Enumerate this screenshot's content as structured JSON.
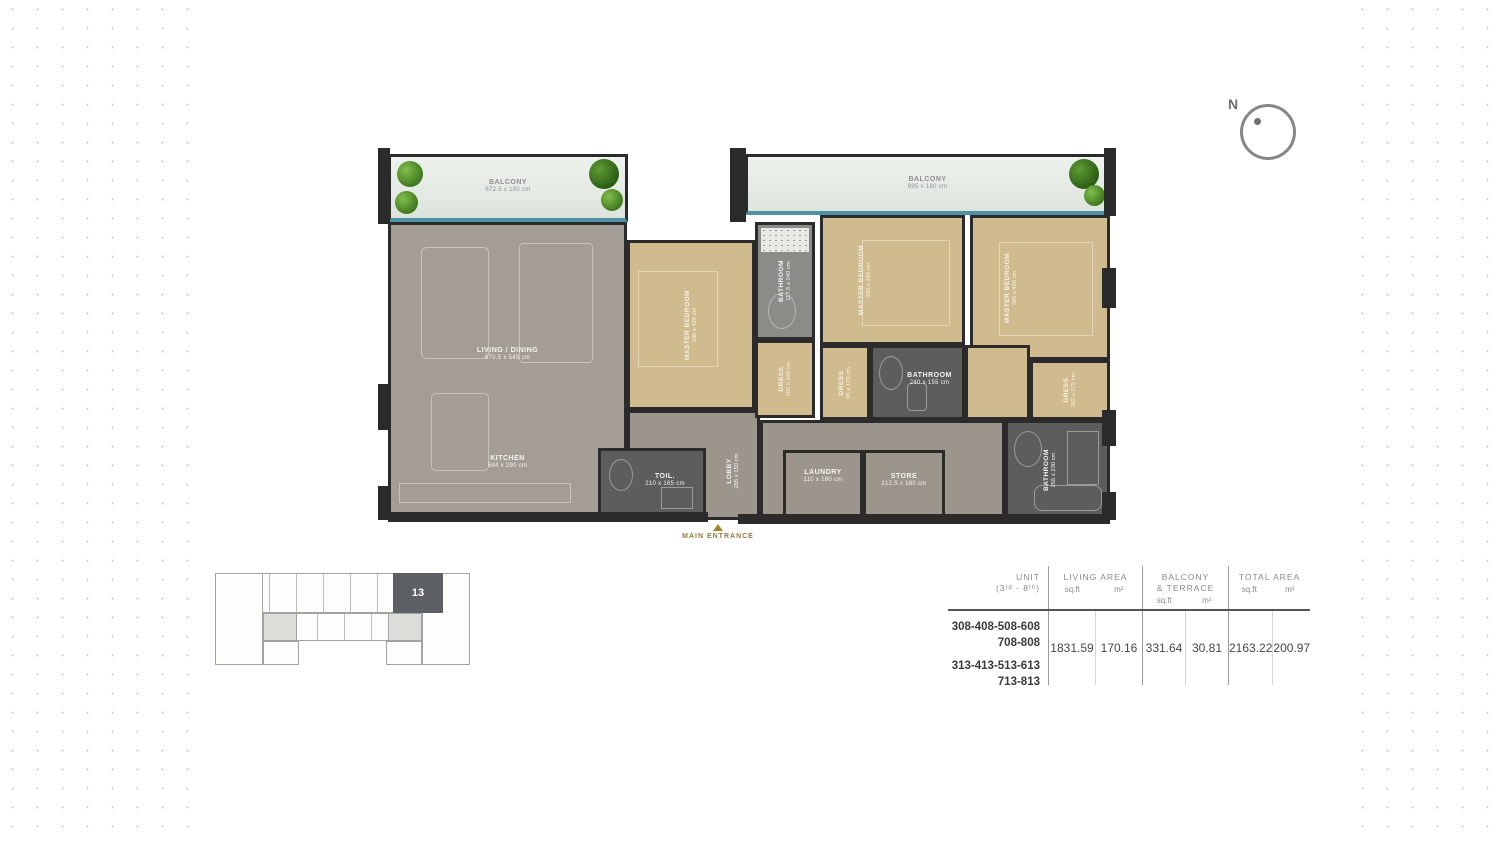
{
  "colors": {
    "wall": "#2b2b2b",
    "floor_gray": "#a49d95",
    "floor_tan": "#cfbb8e",
    "balcony_edge_teal": "#4e93a4",
    "keyplan_highlight": "#5c6065",
    "entrance_gold": "#a3852c",
    "dot_grid": "#c7c7c5"
  },
  "compass": {
    "north_label": "N"
  },
  "floor_plan": {
    "balcony_left": {
      "label": "BALCONY",
      "dims": "672.5 x 180 cm"
    },
    "balcony_right": {
      "label": "BALCONY",
      "dims": "995 x 180 cm"
    },
    "living": {
      "label": "LIVING / DINING",
      "dims": "672.5 x 545 cm"
    },
    "kitchen": {
      "label": "KITCHEN",
      "dims": "584 x 290 cm"
    },
    "bedroom1": {
      "label": "MASTER BEDROOM",
      "dims": "330 x 420 cm"
    },
    "bathroom1": {
      "label": "BATHROOM",
      "dims": "117.5 x 240 cm"
    },
    "bedroom2": {
      "label": "MASTER BEDROOM",
      "dims": "420 x 345 cm"
    },
    "bedroom3": {
      "label": "MASTER BEDROOM",
      "dims": "385 x 480 cm"
    },
    "dress1": {
      "label": "DRESS",
      "dims": "165 x 240 cm"
    },
    "dress2": {
      "label": "DRESS",
      "dims": "95 x 170 cm"
    },
    "dress3": {
      "label": "DRESS",
      "dims": "362 x 175 cm"
    },
    "bathroom_mid": {
      "label": "BATHROOM",
      "dims": "240 x 155 cm"
    },
    "toilet": {
      "label": "TOIL.",
      "dims": "210 x 165 cm"
    },
    "lobby": {
      "label": "LOBBY",
      "dims": "285 x 150 cm"
    },
    "laundry": {
      "label": "LAUNDRY",
      "dims": "110 x 180 cm"
    },
    "store": {
      "label": "STORE",
      "dims": "212.5 x 180 cm"
    },
    "bathroom_br": {
      "label": "BATHROOM",
      "dims": "255 x 230 cm"
    },
    "main_entrance": "MAIN ENTRANCE"
  },
  "key_plan": {
    "highlighted_unit": "13"
  },
  "area_table": {
    "col_unit_line1": "UNIT",
    "col_unit_line2": "(3ʳᵈ - 8ᵗʰ)",
    "col_living": "LIVING AREA",
    "col_balcony_line1": "BALCONY",
    "col_balcony_line2": "& TERRACE",
    "col_total": "TOTAL AREA",
    "sub_sqft": "sq.ft",
    "sub_m2": "m²",
    "unit_rows": [
      "308-408-508-608",
      "708-808",
      "313-413-513-613",
      "713-813"
    ],
    "living_sqft": "1831.59",
    "living_m2": "170.16",
    "balcony_sqft": "331.64",
    "balcony_m2": "30.81",
    "total_sqft": "2163.22",
    "total_m2": "200.97"
  }
}
